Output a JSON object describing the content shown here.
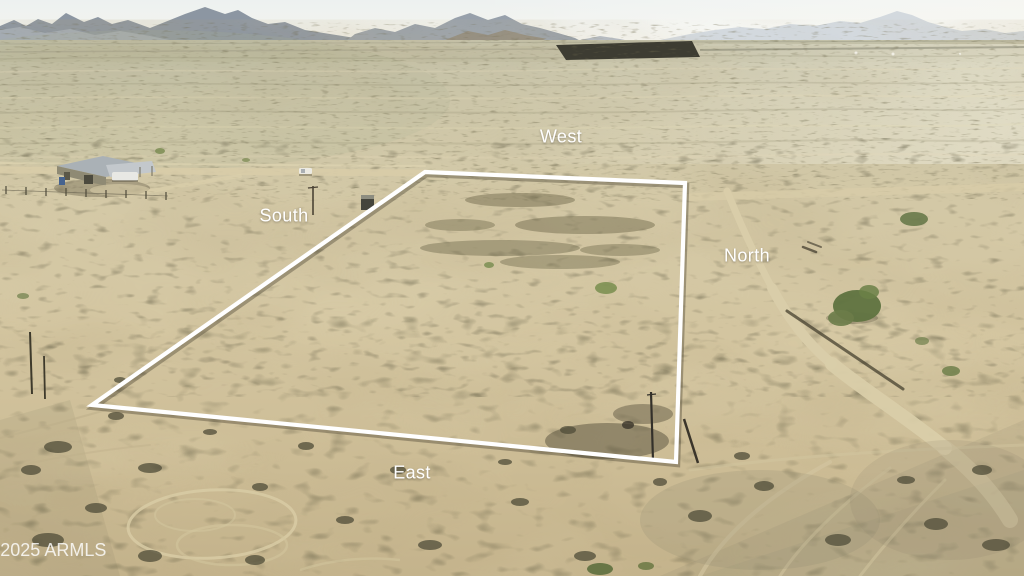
{
  "labels": {
    "west": "West",
    "south": "South",
    "north": "North",
    "east": "East"
  },
  "watermark": {
    "text": "©2025 ARMLS"
  },
  "palette": {
    "boundary": "#ffffff",
    "label_text": "#ffffff",
    "sky": "#eef1ef",
    "mountains": "#8c96a2",
    "desert_light": "#d3c8a6",
    "desert_dark": "#c4b38c",
    "scrub": "#5c5842",
    "dirt_road": "#d9cda9"
  }
}
